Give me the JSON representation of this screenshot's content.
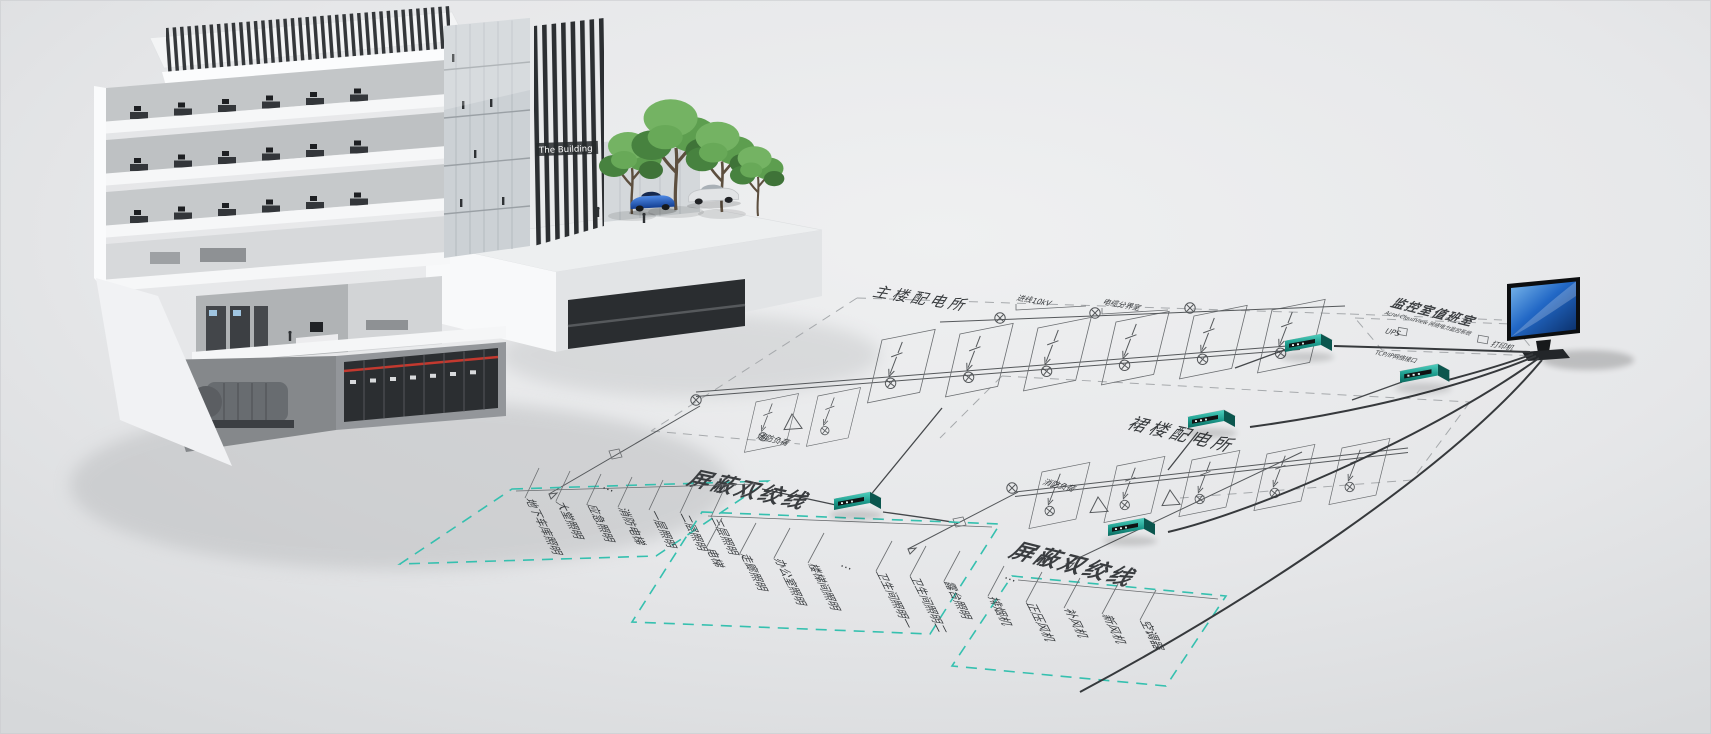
{
  "scene": {
    "building_sign": "The Building"
  },
  "stations": {
    "main_label": "主楼配电所",
    "podium_label": "裙楼配电所",
    "control_room_label": "监控室值班室",
    "control_room_subtitle": "Acrel CloudView 网络电力监控系统"
  },
  "incoming": {
    "line_label": "进线10kV",
    "cable_label": "电缆分界室"
  },
  "bus": {
    "stp_left": "屏蔽双绞线",
    "stp_right": "屏蔽双绞线",
    "fire_left": "消防负荷",
    "fire_right": "消防负荷",
    "ellipsis": "…"
  },
  "control_room": {
    "ups": "UPS",
    "printer": "打印机",
    "network": "TCP/IP网络接口"
  },
  "circuits": {
    "left": [
      "地下车库照明",
      "大堂照明",
      "应急照明",
      "消防电梯",
      "一层照明",
      "二层照明",
      "三层照明"
    ],
    "middle": [
      "电梯",
      "走廊照明",
      "办公室照明",
      "楼梯间照明",
      "卫生间照明一",
      "卫生间照明二",
      "露台照明"
    ],
    "right": [
      "排烟机",
      "正压风机",
      "补风机",
      "新风机",
      "空调器"
    ]
  },
  "colors": {
    "teal_accent": "#2fb9a8",
    "schematic_line": "#4a4d50",
    "screen_blue": "#1663c7",
    "background": "#e6e7e9"
  }
}
